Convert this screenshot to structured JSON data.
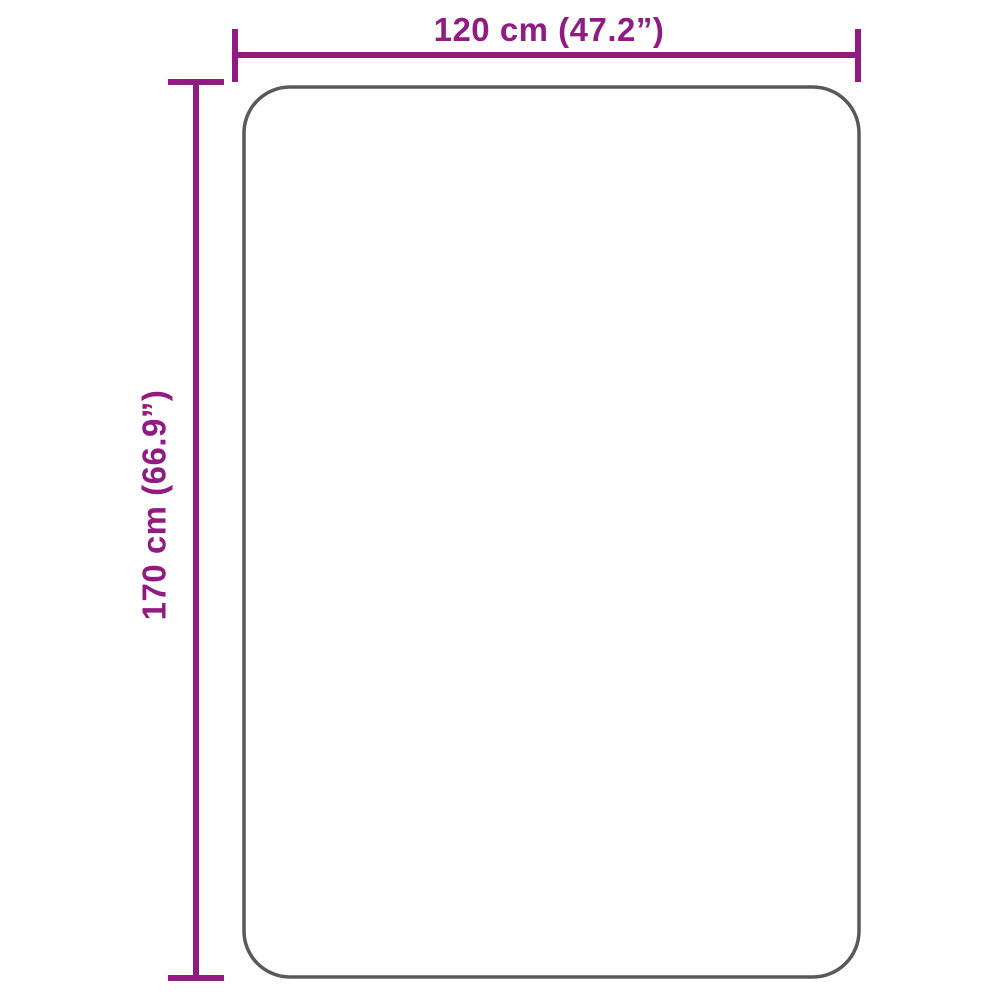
{
  "diagram": {
    "title": "product-dimension-diagram",
    "width_label": "120 cm (47.2”)",
    "height_label": "170 cm (66.9”)",
    "colors": {
      "dimension_lines": "#911c81",
      "product_outline": "#58595b",
      "background": "#ffffff"
    }
  }
}
